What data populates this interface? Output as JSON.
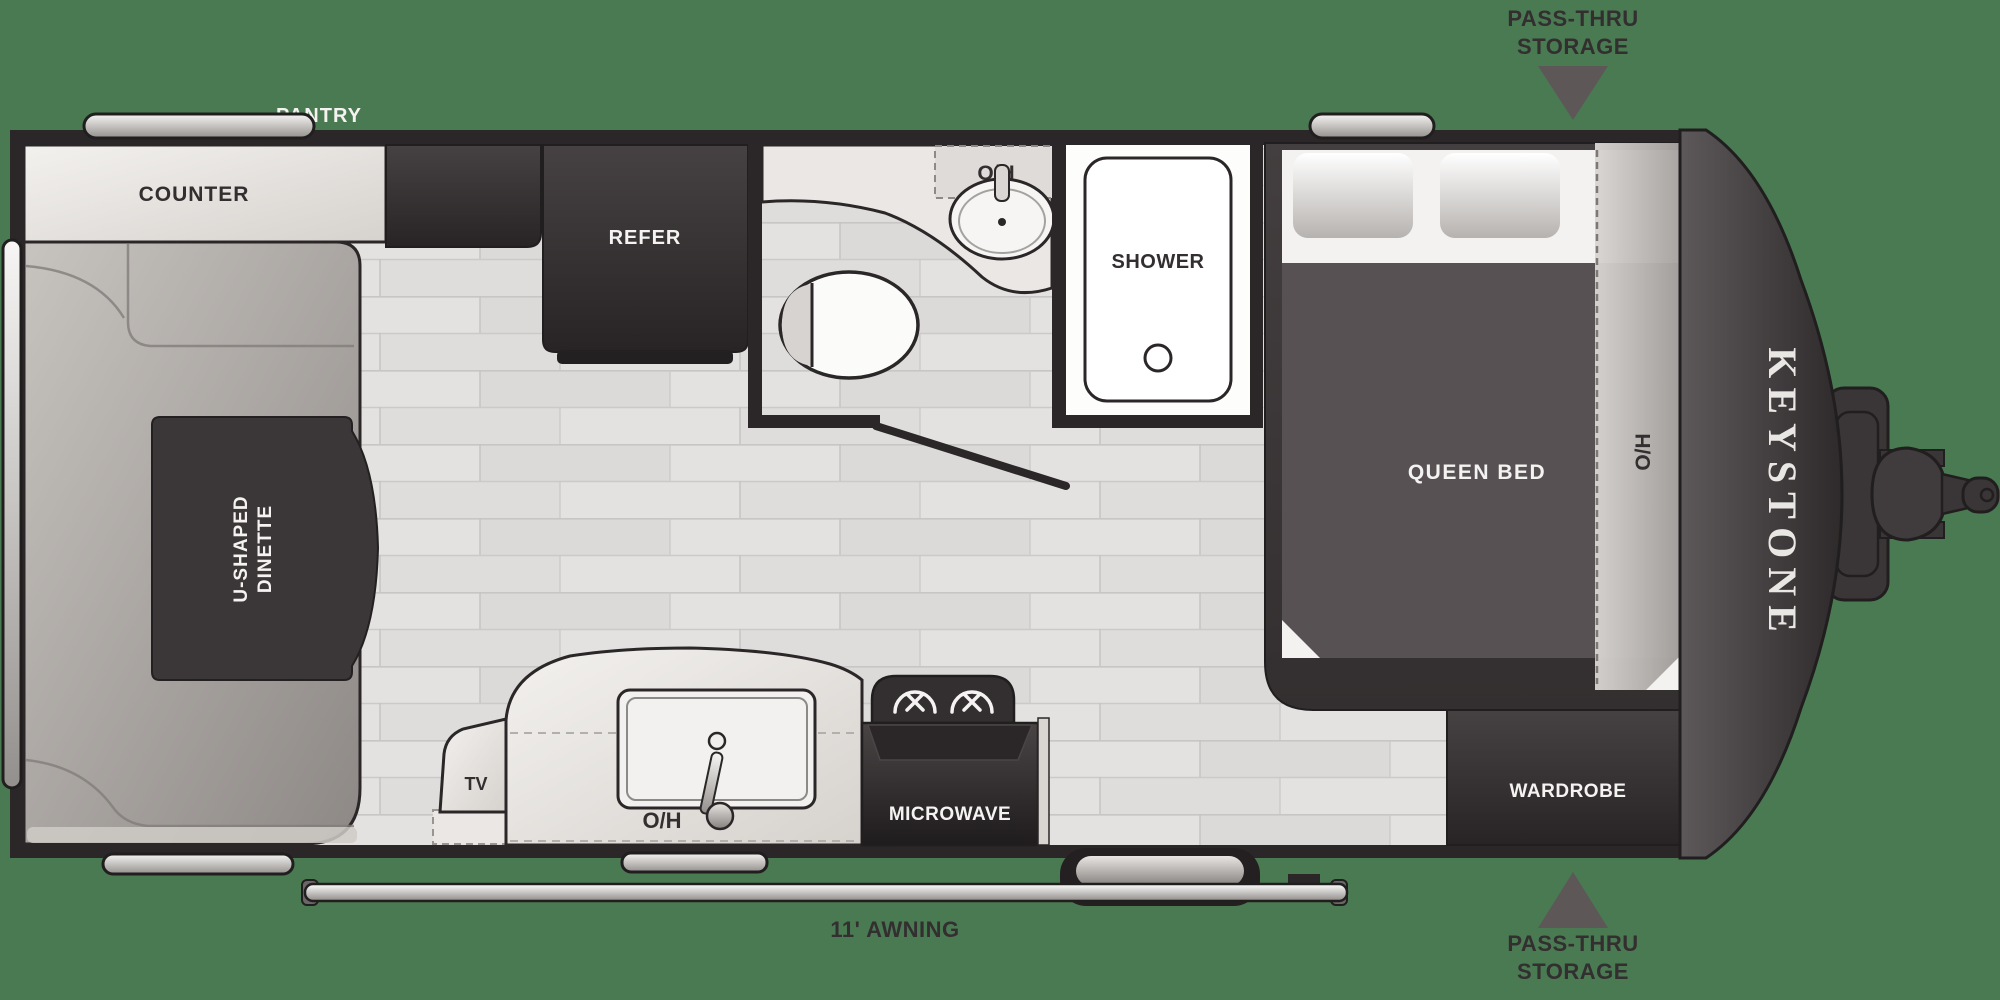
{
  "page": {
    "background_color": "#4a7a52",
    "wall_color": "#2b2728",
    "accent_dark": "#3a3536",
    "floor_color": "#e3e2e0",
    "counter_color": "#ece9e6",
    "bench_color": "#b5b0ac",
    "duvet_color": "#575153",
    "label_dark": "#332f30",
    "label_white": "#f4f3f1"
  },
  "brand": {
    "name": "KEYSTONE"
  },
  "exterior_labels": {
    "pantry": "PANTRY",
    "passthru_line1": "PASS-THRU",
    "passthru_line2": "STORAGE",
    "awning": "11' AWNING"
  },
  "interior_labels": {
    "counter": "COUNTER",
    "refer": "REFER",
    "shower": "SHOWER",
    "overhead": "O/H",
    "queen_bed": "QUEEN BED",
    "dinette_line1": "U-SHAPED",
    "dinette_line2": "DINETTE",
    "tv": "TV",
    "microwave": "MICROWAVE",
    "wardrobe": "WARDROBE"
  }
}
